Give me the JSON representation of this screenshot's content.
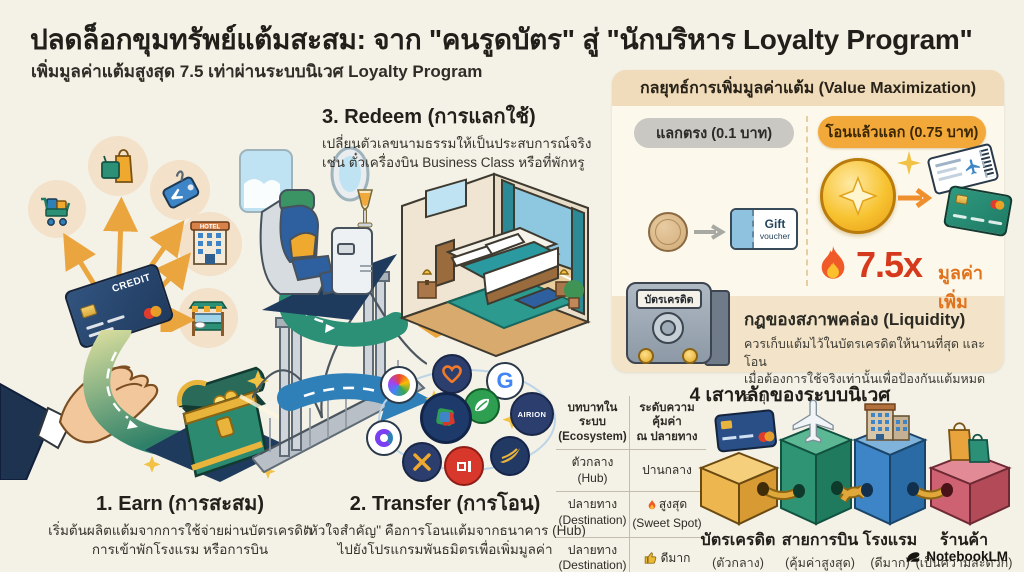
{
  "page": {
    "title": "ปลดล็อกขุมทรัพย์แต้มสะสม: จาก \"คนรูดบัตร\" สู่ \"นักบริหาร Loyalty Program\"",
    "subtitle": "เพิ่มมูลค่าแต้มสูงสุด 7.5 เท่าผ่านระบบนิเวศ Loyalty Program",
    "watermark": "NotebookLM"
  },
  "steps": {
    "earn": {
      "title": "1. Earn (การสะสม)",
      "line1": "เริ่มต้นผลิตแต้มจากการใช้จ่ายผ่านบัตรเครดิต",
      "line2": "การเข้าพักโรงแรม หรือการบิน"
    },
    "transfer": {
      "title": "2. Transfer (การโอน)",
      "line1": "\"หัวใจสำคัญ\" คือการโอนแต้มจากธนาคาร (Hub)",
      "line2": "ไปยังโปรแกรมพันธมิตรเพื่อเพิ่มมูลค่า"
    },
    "redeem": {
      "title": "3. Redeem (การแลกใช้)",
      "line1": "เปลี่ยนตัวเลขนามธรรมให้เป็นประสบการณ์จริง",
      "line2": "เช่น ตั๋วเครื่องบิน Business Class หรือที่พักหรู"
    }
  },
  "illustration": {
    "card_text": "CREDIT",
    "hotel_sign": "HOTEL",
    "partner_badge": "AIRION",
    "partner_g": "G"
  },
  "value_panel": {
    "title": "กลยุทธ์การเพิ่มมูลค่าแต้ม (Value Maximization)",
    "direct_label": "แลกตรง (0.1 บาท)",
    "voucher_line1": "Gift",
    "voucher_line2": "voucher",
    "transfer_label": "โอนแล้วแลก (0.75 บาท)",
    "multiplier": "7.5x",
    "multiplier_note": "มูลค่าเพิ่ม",
    "safe_label": "บัตรเครดิต",
    "liquidity_title": "กฎของสภาพคล่อง (Liquidity)",
    "liquidity_line1": "ควรเก็บแต้มไว้ในบัตรเครดิตให้นานที่สุด และโอน",
    "liquidity_line2": "เมื่อต้องการใช้จริงเท่านั้นเพื่อป้องกันแต้มหมดอายุ"
  },
  "pillars": {
    "title": "4 เสาหลักของระบบนิเวศ",
    "table": {
      "col1_line1": "บทบาทในระบบ",
      "col1_line2": "(Ecosystem)",
      "col2_line1": "ระดับความคุ้มค่า",
      "col2_line2": "ณ ปลายทาง",
      "rows": [
        {
          "role1": "ตัวกลาง",
          "role2": "(Hub)",
          "value1": "ปานกลาง",
          "value2": ""
        },
        {
          "role1": "ปลายทาง",
          "role2": "(Destination)",
          "value1": "สูงสุด",
          "value2": "(Sweet Spot)"
        },
        {
          "role1": "ปลายทาง",
          "role2": "(Destination)",
          "value1": "ดีมาก",
          "value2": ""
        }
      ]
    },
    "items": [
      {
        "label": "บัตรเครดิต",
        "sub": "(ตัวกลาง)",
        "note": ""
      },
      {
        "label": "สายการบิน",
        "sub": "(คุ้มค่าสูงสุด)",
        "note": "Sweet Spot"
      },
      {
        "label": "โรงแรม",
        "sub": "(ดีมาก)",
        "note": ""
      },
      {
        "label": "ร้านค้า",
        "sub": "(เป็นความสะดวก)",
        "note": ""
      }
    ]
  },
  "chart_data": {
    "type": "table",
    "title": "4 เสาหลักของระบบนิเวศ",
    "columns": [
      "บทบาทในระบบ (Ecosystem)",
      "ระดับความคุ้มค่า ณ ปลายทาง"
    ],
    "rows": [
      [
        "ตัวกลาง (Hub)",
        "ปานกลาง"
      ],
      [
        "ปลายทาง (Destination)",
        "สูงสุด (Sweet Spot)"
      ],
      [
        "ปลายทาง (Destination)",
        "ดีมาก"
      ]
    ],
    "comparison": {
      "direct_redeem_value_baht": 0.1,
      "transfer_then_redeem_value_baht": 0.75,
      "multiplier": 7.5
    }
  },
  "colors": {
    "background": "#f4f1e6",
    "panel_tan": "#f3e4c9",
    "accent_orange": "#f3a93a",
    "accent_red": "#d63a1c",
    "road_green": "#2e8068",
    "arrow_blue": "#2f7fb8",
    "box_yellow": "#eeb64f",
    "box_green": "#2f9474",
    "box_blue": "#3d85c6",
    "box_red": "#cf6272"
  }
}
